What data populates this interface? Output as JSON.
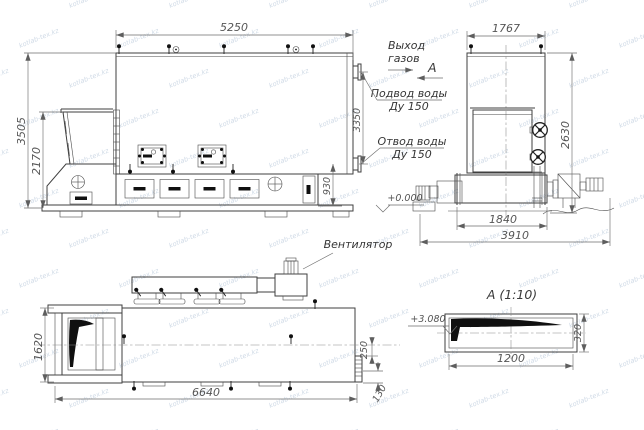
{
  "watermark": {
    "text": "kotlab-tex.kz",
    "color": "#a9bcd2"
  },
  "colors": {
    "line": "#3f3f3f",
    "dim_text": "#565656",
    "label_text": "#353535",
    "fill_black": "#101010",
    "background": "#ffffff"
  },
  "side_view": {
    "dim_width": "5250",
    "dim_height_total": "3505",
    "dim_height_hopper": "2170",
    "dim_pipes_span": "3350",
    "dim_pipe_height": "930"
  },
  "front_view": {
    "dim_width": "1767",
    "dim_height": "2630",
    "dim_base": "1840",
    "dim_overall": "3910"
  },
  "plan_view": {
    "dim_depth": "1620",
    "dim_length": "6640",
    "dim_offset": "250",
    "dim_flange": "130",
    "fan_label": "Вентилятор"
  },
  "section_a": {
    "title": "А  (1:10)",
    "dim_width": "1200",
    "dim_height": "320",
    "level_mark": "+3.080"
  },
  "annotations": {
    "gas_outlet_1": "Выход",
    "gas_outlet_2": "газов",
    "section_letter": "А",
    "water_in_1": "Подвод воды",
    "water_in_2": "Ду 150",
    "water_out_1": "Отвод воды",
    "water_out_2": "Ду 150",
    "level_zero": "+0.000"
  }
}
